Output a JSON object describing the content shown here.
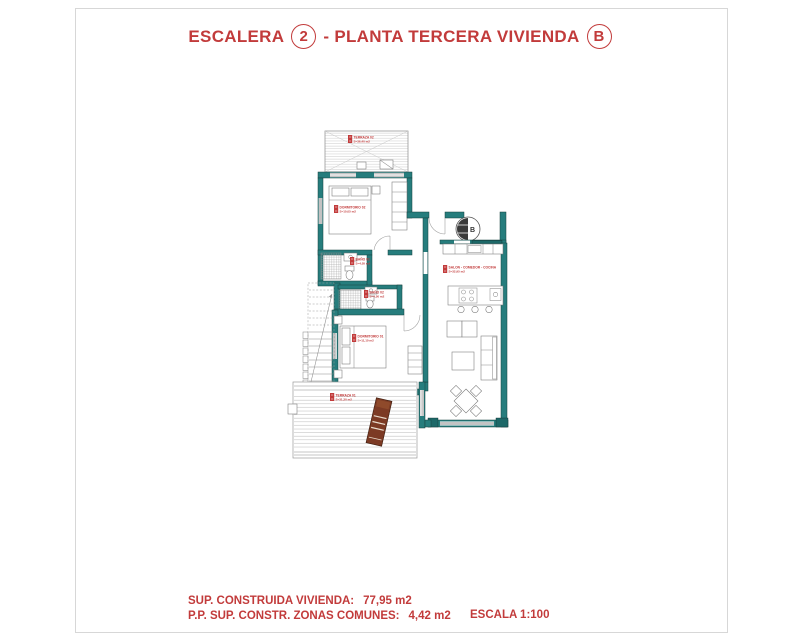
{
  "title": {
    "word1": "ESCALERA",
    "num": "2",
    "word2": "- PLANTA TERCERA VIVIENDA",
    "letter": "B"
  },
  "plan": {
    "entry_marker": "B",
    "rooms": [
      {
        "name": "TERRAZA 02",
        "area": "S=36,40 m2"
      },
      {
        "name": "DORMITORIO 02",
        "area": "S=10,05 m2"
      },
      {
        "name": "BAÑO 01",
        "area": "S=4,05 m2"
      },
      {
        "name": "BAÑO 02",
        "area": "S=4,50 m2"
      },
      {
        "name": "DORMITORIO 01",
        "area": "S=11,10 m2"
      },
      {
        "name": "SALON - COMEDOR - COCINA",
        "area": "S=32,95 m2"
      },
      {
        "name": "TERRAZA 01",
        "area": "S=31,30 m2"
      }
    ],
    "colors": {
      "wall_teal": "#267d7d",
      "wall_dark": "#1d6868",
      "label_red": "#c23b3b",
      "hatch_gray": "#bdbdbd",
      "chair_brown": "#7c3a24"
    }
  },
  "footer": {
    "line1_label": "SUP. CONSTRUIDA VIVIENDA:",
    "line1_value": "77,95 m2",
    "line2_label": "P.P. SUP. CONSTR. ZONAS COMUNES:",
    "line2_value": "4,42 m2",
    "scale": "ESCALA 1:100"
  }
}
